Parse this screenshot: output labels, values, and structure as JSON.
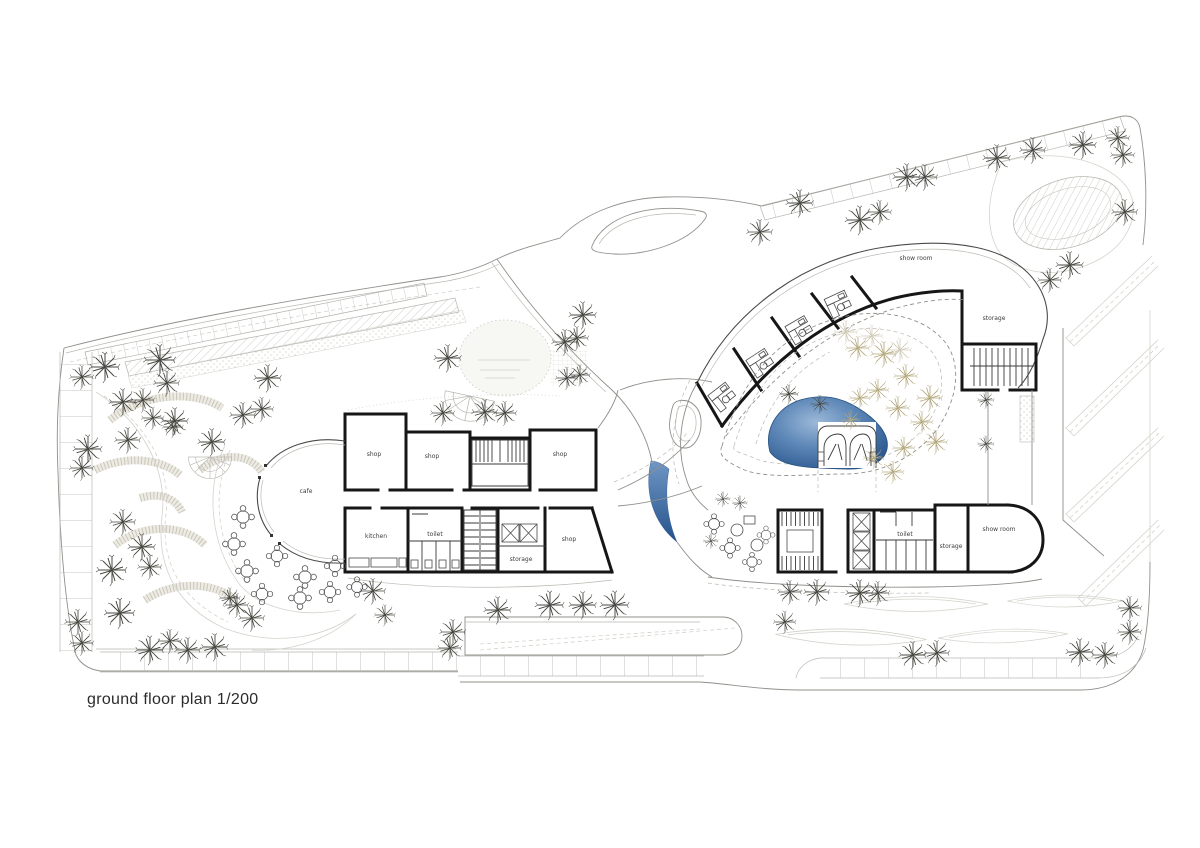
{
  "title": "ground floor plan 1/200",
  "drawing": {
    "type": "architectural ground floor plan",
    "scale": "1/200"
  },
  "left_wing": {
    "rooms": [
      "shop",
      "shop",
      "shop",
      "cafe",
      "kitchen",
      "toilet",
      "storage",
      "shop"
    ]
  },
  "right_wing": {
    "rooms": [
      "show room",
      "storage",
      "toilet",
      "storage",
      "show room"
    ]
  },
  "colors": {
    "paper": "#ffffff",
    "wall": "#161616",
    "thin_line": "#8f8f8a",
    "faint_line": "#d3d3cc",
    "pool_dark": "#29558e",
    "pool_light": "#9cb9d8",
    "water_crescent": "#31609c",
    "tree_dark": "#474740",
    "tree_beige": "#b4a87e",
    "title_text": "#2b2b2b"
  }
}
